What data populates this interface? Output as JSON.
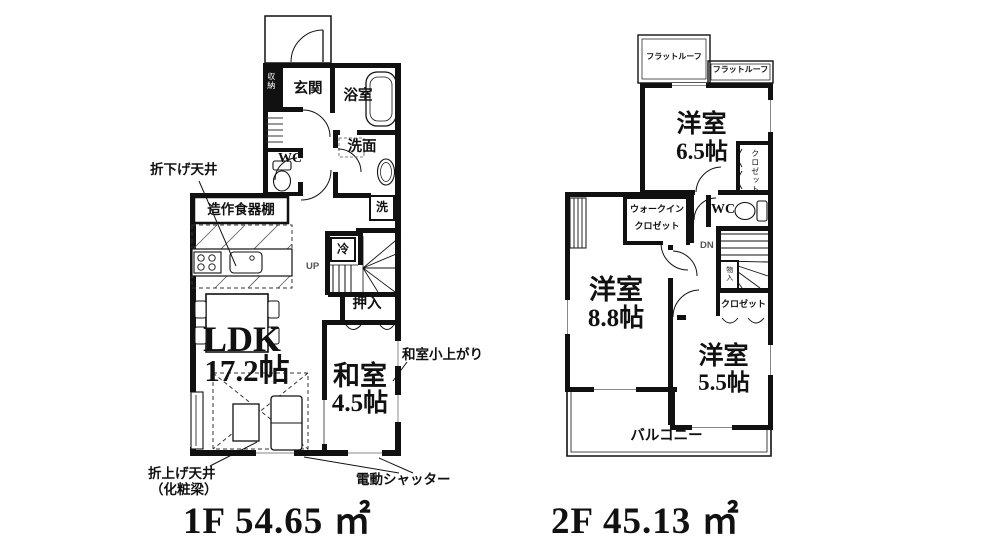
{
  "floor1": {
    "rooms": {
      "genkan": "玄関",
      "bathroom": "浴室",
      "washroom": "洗面",
      "wc": "WC",
      "oshiire": "押入",
      "ldk_name": "LDK",
      "ldk_size": "17.2帖",
      "washitsu_name": "和室",
      "washitsu_size": "4.5帖",
      "entry_storage": "収納"
    },
    "fixtures": {
      "cupboard": "造作食器棚",
      "washer": "洗",
      "fridge": "冷",
      "up": "UP"
    },
    "annotations": {
      "dropped_ceiling": "折下げ天井",
      "raised_ceiling_1": "折上げ天井",
      "raised_ceiling_2": "（化粧梁）",
      "tatami_step": "和室小上がり",
      "electric_shutter": "電動シャッター"
    },
    "area_label": "1F 54.65 ㎡"
  },
  "floor2": {
    "rooms": {
      "room_65_name": "洋室",
      "room_65_size": "6.5帖",
      "room_88_name": "洋室",
      "room_88_size": "8.8帖",
      "room_55_name": "洋室",
      "room_55_size": "5.5帖",
      "wic_line1": "ウォークイン",
      "wic_line2": "クロゼット",
      "closet_65": "クロゼット",
      "closet_55": "クロゼット",
      "monoire": "物入",
      "wc": "WC",
      "balcony": "バルコニー"
    },
    "annotations": {
      "flat_roof_1": "フラットルーフ",
      "flat_roof_2": "フラットルーフ",
      "dn": "DN"
    },
    "area_label": "2F 45.13 ㎡"
  },
  "colors": {
    "line": "#111111",
    "background": "#ffffff"
  }
}
